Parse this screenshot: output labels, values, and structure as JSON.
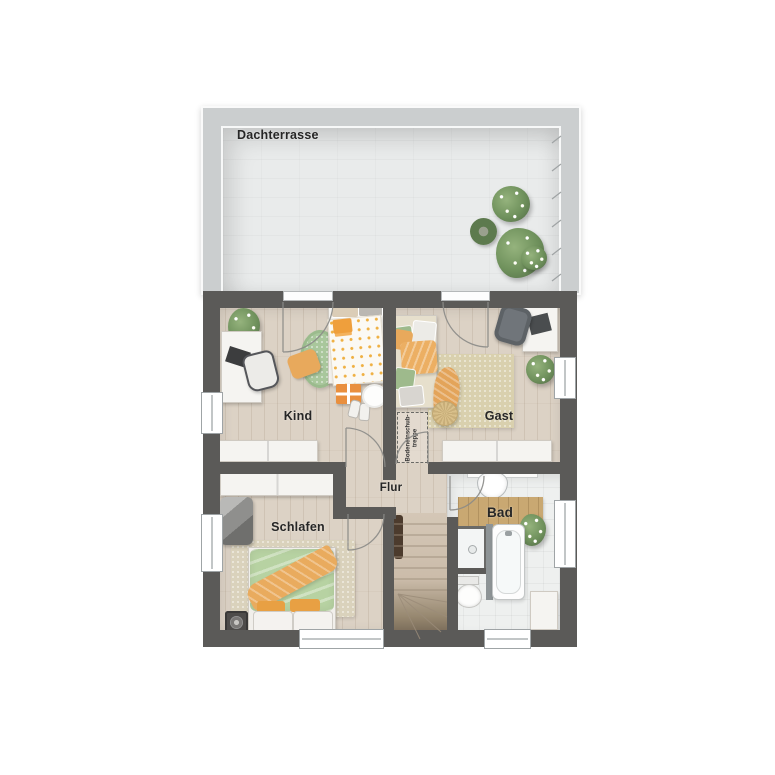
{
  "labels": {
    "terrace": "Dachterrasse",
    "kind": "Kind",
    "gast": "Gast",
    "flur": "Flur",
    "schlafen": "Schlafen",
    "bad": "Bad",
    "attic_line1": "Bodeneinschub-",
    "attic_line2": "treppe"
  },
  "colors": {
    "wall": "#5b5a58",
    "parapet": "#cbcecf",
    "terrace_floor": "#e9ebeb",
    "wood_floor": "#dcd2c5",
    "bath_tile": "#eef0ef",
    "rug_green": "#a9c79c",
    "rug_beige": "#d9d0ae",
    "accent_orange": "#e8a95c",
    "accent_green": "#b7d2a2",
    "stair_wood": "#cfc1b0",
    "bad_mat_wood": "#c9a872"
  }
}
